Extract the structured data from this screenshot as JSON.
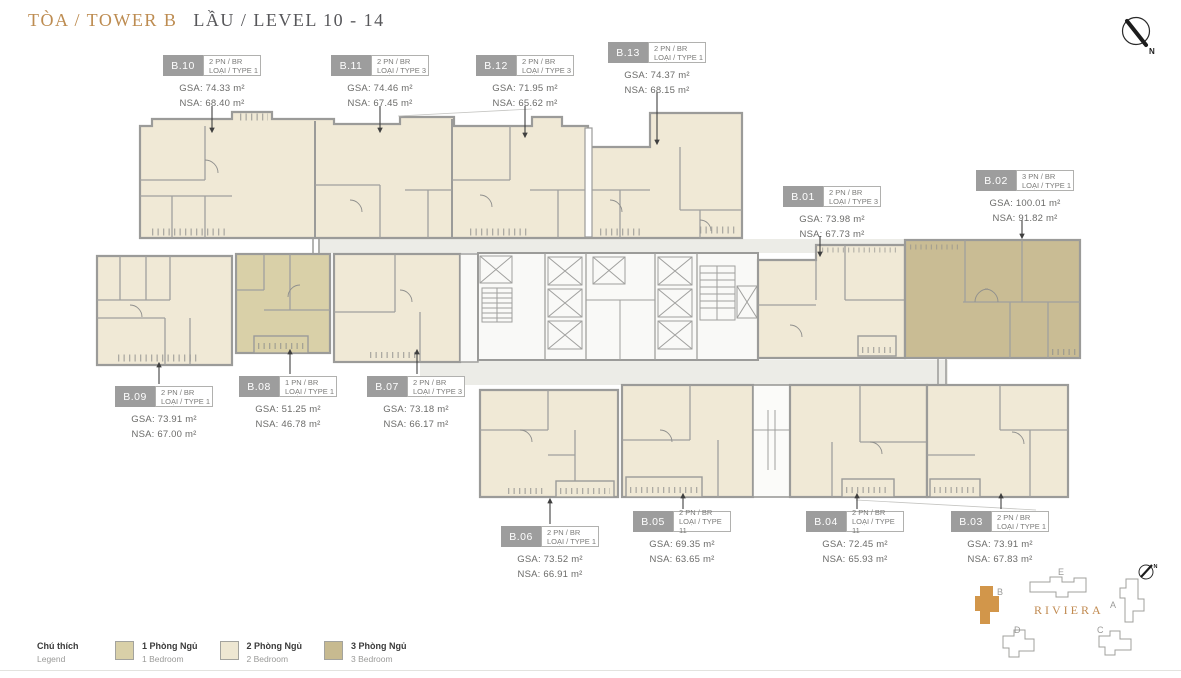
{
  "title": {
    "tower": "TÒA / TOWER B",
    "level": "LẦU / LEVEL 10 - 14"
  },
  "units": [
    {
      "id": "B.10",
      "type_line1": "2 PN / BR",
      "type_line2": "LOẠI / TYPE 1",
      "gsa": "GSA: 74.33 m²",
      "nsa": "NSA: 68.40 m²",
      "bedrooms": "2"
    },
    {
      "id": "B.11",
      "type_line1": "2 PN / BR",
      "type_line2": "LOẠI / TYPE 3",
      "gsa": "GSA: 74.46 m²",
      "nsa": "NSA: 67.45 m²",
      "bedrooms": "2"
    },
    {
      "id": "B.12",
      "type_line1": "2 PN / BR",
      "type_line2": "LOẠI / TYPE 3",
      "gsa": "GSA: 71.95 m²",
      "nsa": "NSA: 65.62 m²",
      "bedrooms": "2"
    },
    {
      "id": "B.13",
      "type_line1": "2 PN / BR",
      "type_line2": "LOẠI / TYPE 1",
      "gsa": "GSA: 74.37 m²",
      "nsa": "NSA: 68.15 m²",
      "bedrooms": "2"
    },
    {
      "id": "B.01",
      "type_line1": "2 PN / BR",
      "type_line2": "LOẠI / TYPE 3",
      "gsa": "GSA: 73.98 m²",
      "nsa": "NSA: 67.73 m²",
      "bedrooms": "2"
    },
    {
      "id": "B.02",
      "type_line1": "3 PN / BR",
      "type_line2": "LOẠI / TYPE 1",
      "gsa": "GSA: 100.01 m²",
      "nsa": "NSA: 91.82 m²",
      "bedrooms": "3"
    },
    {
      "id": "B.09",
      "type_line1": "2 PN / BR",
      "type_line2": "LOẠI / TYPE 1",
      "gsa": "GSA: 73.91 m²",
      "nsa": "NSA: 67.00 m²",
      "bedrooms": "2"
    },
    {
      "id": "B.08",
      "type_line1": "1 PN / BR",
      "type_line2": "LOẠI / TYPE 1",
      "gsa": "GSA: 51.25 m²",
      "nsa": "NSA: 46.78 m²",
      "bedrooms": "1"
    },
    {
      "id": "B.07",
      "type_line1": "2 PN / BR",
      "type_line2": "LOẠI / TYPE 3",
      "gsa": "GSA: 73.18 m²",
      "nsa": "NSA: 66.17 m²",
      "bedrooms": "2"
    },
    {
      "id": "B.06",
      "type_line1": "2 PN / BR",
      "type_line2": "LOẠI / TYPE 1",
      "gsa": "GSA: 73.52 m²",
      "nsa": "NSA: 66.91 m²",
      "bedrooms": "2"
    },
    {
      "id": "B.05",
      "type_line1": "2 PN / BR",
      "type_line2": "LOẠI / TYPE 11",
      "gsa": "GSA: 69.35 m²",
      "nsa": "NSA: 63.65 m²",
      "bedrooms": "2"
    },
    {
      "id": "B.04",
      "type_line1": "2 PN / BR",
      "type_line2": "LOẠI / TYPE 11",
      "gsa": "GSA: 72.45 m²",
      "nsa": "NSA: 65.93 m²",
      "bedrooms": "2"
    },
    {
      "id": "B.03",
      "type_line1": "2 PN / BR",
      "type_line2": "LOẠI / TYPE 1",
      "gsa": "GSA: 73.91 m²",
      "nsa": "NSA: 67.83 m²",
      "bedrooms": "2"
    }
  ],
  "legend": {
    "heading_line1": "Chú thích",
    "heading_line2": "Legend",
    "items": [
      {
        "line1": "1 Phòng Ngủ",
        "line2": "1 Bedroom",
        "color": "#d9d0a8"
      },
      {
        "line1": "2 Phòng Ngủ",
        "line2": "2 Bedroom",
        "color": "#eee7d2"
      },
      {
        "line1": "3 Phòng Ngủ",
        "line2": "3 Bedroom",
        "color": "#c7ba90"
      }
    ]
  },
  "minimap": {
    "project_name": "RIVIERA",
    "highlighted_building": "B",
    "buildings": [
      {
        "label": "E",
        "highlighted": false
      },
      {
        "label": "B",
        "highlighted": true
      },
      {
        "label": "A",
        "highlighted": false
      },
      {
        "label": "D",
        "highlighted": false
      },
      {
        "label": "C",
        "highlighted": false
      }
    ],
    "compass_label": "N"
  },
  "compass": {
    "label": "N"
  },
  "palette": {
    "accent_gold": "#bd8c51",
    "title_gray": "#57575a",
    "badge_bg": "#9d9d9d",
    "wall_gray": "#9b9b99",
    "fill_1_bedroom": "#d9d0a8",
    "fill_2_bedroom": "#f0e9d6",
    "fill_3_bedroom": "#c9bc94",
    "corridor_gray": "#ecece7",
    "minimap_highlight": "#d2964a"
  }
}
